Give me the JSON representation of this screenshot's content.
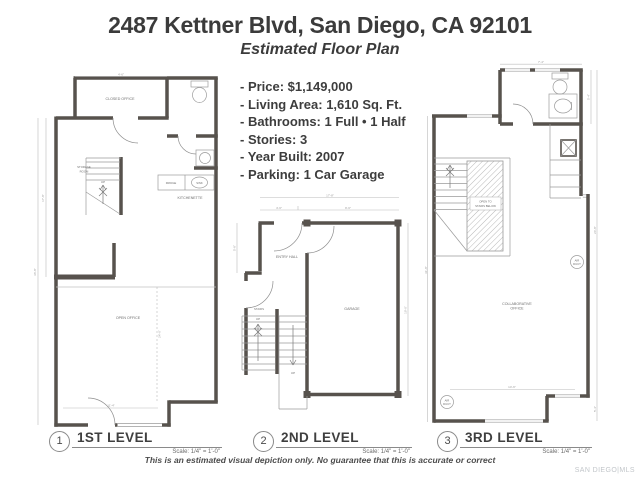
{
  "header": {
    "title": "2487 Kettner Blvd, San Diego, CA 92101",
    "subtitle": "Estimated Floor Plan"
  },
  "details": {
    "items": [
      "- Price: $1,149,000",
      "- Living Area: 1,610 Sq. Ft.",
      "- Bathrooms: 1 Full • 1 Half",
      "- Stories: 3",
      "- Year Built: 2007",
      "- Parking: 1 Car Garage"
    ]
  },
  "plans": {
    "level1": {
      "number": "1",
      "label": "1ST LEVEL",
      "scale": "Scale: 1/4\" = 1'-0\"",
      "rooms": {
        "closed_office": "CLOSED OFFICE",
        "storage_1": "STORAGE",
        "storage_2": "ROOM",
        "kitchenette": "KITCHENETTE",
        "fridge": "FRIDGE",
        "sink": "SINK",
        "open_office": "OPEN OFFICE",
        "up": "UP"
      },
      "dims": {
        "top": "4'-6\"",
        "left_inner": "17'-8\"",
        "left_outer": "36'-8\"",
        "bottom": "11'-4\"",
        "center": "24'-6\""
      }
    },
    "level2": {
      "number": "2",
      "label": "2ND LEVEL",
      "scale": "Scale: 1/4\" = 1'-0\"",
      "rooms": {
        "entry_hall": "ENTRY HALL",
        "stairs": "STAIRS",
        "garage": "GARAGE",
        "up": "UP"
      },
      "dims": {
        "top": "17'-8\"",
        "top_left": "4'-6\"",
        "top_right": "9'-6\"",
        "left": "5'-8\"",
        "right": "19'-6\""
      }
    },
    "level3": {
      "number": "3",
      "label": "3RD LEVEL",
      "scale": "Scale: 1/4\" = 1'-0\"",
      "rooms": {
        "open_below_1": "OPEN TO",
        "open_below_2": "STAIRS BELOW",
        "collab_1": "COLLABORATIVE",
        "collab_2": "OFFICE",
        "air_1": "AIR",
        "air_2": "DUCT"
      },
      "dims": {
        "top": "7'-4\"",
        "right_top": "5'-4\"",
        "left": "31'-8\"",
        "right": "24'-8\"",
        "bottom": "14'-6\"",
        "bottom_right": "5'-4\""
      }
    }
  },
  "footer": {
    "disclaimer": "This is an estimated visual depiction only. No guarantee that this is accurate or correct",
    "watermark": "SAN DIEGO|MLS"
  },
  "colors": {
    "wall": "#57524d",
    "thin_line": "#9b9b9b",
    "dim_line": "#bcbcbc"
  }
}
